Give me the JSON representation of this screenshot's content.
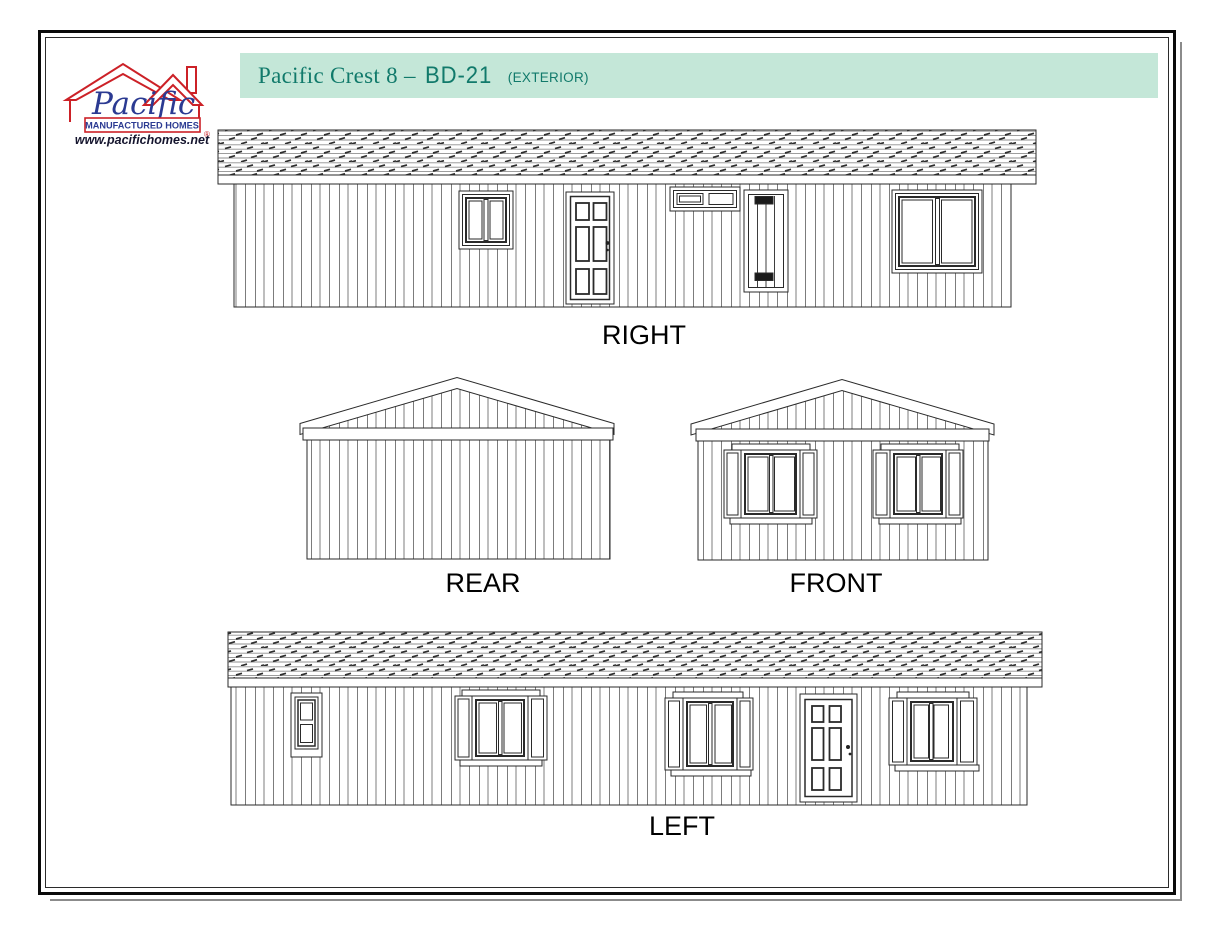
{
  "page": {
    "background": "#ffffff",
    "border_color": "#0a0a0a",
    "shadow_color": "#8b8b8b"
  },
  "logo": {
    "name": "Pacific",
    "tagline": "MANUFACTURED HOMES",
    "registered_mark": "®",
    "url": "www.pacifichomes.net",
    "house_color": "#cc2127",
    "text_color": "#2b3a92"
  },
  "header": {
    "title_main": "Pacific Crest 8 –",
    "model": "BD-21",
    "suffix": "(EXTERIOR)",
    "bar_color": "#c4e7d8",
    "text_color": "#117a6b"
  },
  "elevations": [
    {
      "id": "right",
      "label": "RIGHT",
      "features": [
        "slider window",
        "six-panel entry door",
        "horizontal vent window",
        "utility access door with vents",
        "large slider window"
      ]
    },
    {
      "id": "rear",
      "label": "REAR",
      "features": [
        "gable end with vertical siding, no openings"
      ]
    },
    {
      "id": "front",
      "label": "FRONT",
      "features": [
        "shuttered slider window",
        "shuttered slider window"
      ]
    },
    {
      "id": "left",
      "label": "LEFT",
      "features": [
        "small two-pane window",
        "shuttered slider window",
        "shuttered slider window",
        "six-panel entry door",
        "shuttered slider window"
      ]
    }
  ]
}
